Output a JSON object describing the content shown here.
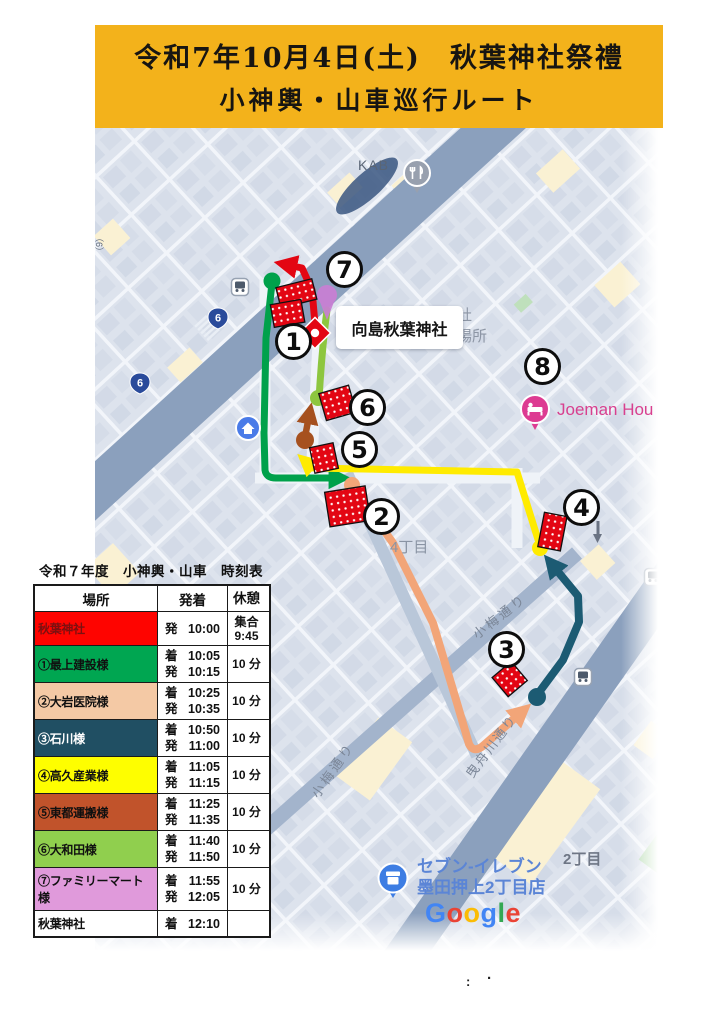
{
  "banner": {
    "line1": "令和7年10月4日(土)　秋葉神社祭禮",
    "line2": "小神輿・山車巡行ルート",
    "bg": "#F3B21B"
  },
  "colors": {
    "route_red": "#E30613",
    "route_green": "#00A14B",
    "route_lightgreen": "#8DC63F",
    "route_yellow": "#FFEB00",
    "route_brown": "#A6511F",
    "route_peach": "#F2A578",
    "route_teal": "#1C5B73",
    "pin_purple": "#C97FD4",
    "pin_hotel": "#DD3B92",
    "pin_house": "#4A7BE8",
    "pin_store": "#3D7DE3",
    "pin_restaurant": "#98A0AE",
    "shrine_pin_red": "#E30613",
    "road": "#8BA0BD",
    "map_label_gray": "#7C8798",
    "poi_label_blue": "#5B85D6",
    "joeman_label_pink": "#D8408F"
  },
  "map": {
    "labels": {
      "kab": "KAB",
      "shrine_box": "向島秋葉神社",
      "hidden1": "社",
      "hidden2": "場所",
      "joeman": "Joeman Hou",
      "chome4": "4丁目",
      "koume1": "小梅通り",
      "koume2": "小梅通り",
      "hikifune": "曳舟川通り",
      "chome2": "2丁目",
      "seveneleven_line1": "セブン-イレブン",
      "seveneleven_line2": "墨田押上2丁目店",
      "route6": "6",
      "edge_fragment": "（6）"
    },
    "google_letters": [
      "G",
      "o",
      "o",
      "g",
      "l",
      "e"
    ],
    "google_colors": [
      "#4285F4",
      "#EA4335",
      "#FBBC05",
      "#4285F4",
      "#34A853",
      "#EA4335"
    ],
    "stops": [
      {
        "n": "1"
      },
      {
        "n": "2"
      },
      {
        "n": "3"
      },
      {
        "n": "4"
      },
      {
        "n": "5"
      },
      {
        "n": "6"
      },
      {
        "n": "7"
      },
      {
        "n": "8"
      }
    ]
  },
  "timetable": {
    "title": "令和７年度　小神輿・山車　時刻表",
    "headers": [
      "場所",
      "発着",
      "休憩"
    ],
    "rows": [
      {
        "place": "秋葉神社",
        "bg": "#FE0400",
        "fg": "#7B1010",
        "t1k": "発",
        "t1v": "10:00",
        "t2k": "",
        "t2v": "",
        "r1": "集合",
        "r2": "9:45"
      },
      {
        "place": "①最上建設様",
        "bg": "#00A651",
        "fg": "#101010",
        "t1k": "着",
        "t1v": "10:05",
        "t2k": "発",
        "t2v": "10:15",
        "r1": "10 分",
        "r2": ""
      },
      {
        "place": "②大岩医院様",
        "bg": "#F4C9A5",
        "fg": "#101010",
        "t1k": "着",
        "t1v": "10:25",
        "t2k": "発",
        "t2v": "10:35",
        "r1": "10 分",
        "r2": ""
      },
      {
        "place": "③石川様",
        "bg": "#204F63",
        "fg": "#FFFFFF",
        "t1k": "着",
        "t1v": "10:50",
        "t2k": "発",
        "t2v": "11:00",
        "r1": "10 分",
        "r2": ""
      },
      {
        "place": "④高久産業様",
        "bg": "#FEFE00",
        "fg": "#101010",
        "t1k": "着",
        "t1v": "11:05",
        "t2k": "発",
        "t2v": "11:15",
        "r1": "10 分",
        "r2": ""
      },
      {
        "place": "⑤東都運搬様",
        "bg": "#C1532B",
        "fg": "#101010",
        "t1k": "着",
        "t1v": "11:25",
        "t2k": "発",
        "t2v": "11:35",
        "r1": "10 分",
        "r2": ""
      },
      {
        "place": "⑥大和田様",
        "bg": "#90CF4E",
        "fg": "#101010",
        "t1k": "着",
        "t1v": "11:40",
        "t2k": "発",
        "t2v": "11:50",
        "r1": "10 分",
        "r2": ""
      },
      {
        "place": "⑦ファミリーマート様",
        "bg": "#E09ADB",
        "fg": "#101010",
        "t1k": "着",
        "t1v": "11:55",
        "t2k": "発",
        "t2v": "12:05",
        "r1": "10 分",
        "r2": ""
      },
      {
        "place": "秋葉神社",
        "bg": "#FFFFFF",
        "fg": "#101010",
        "t1k": "着",
        "t1v": "12:10",
        "t2k": "",
        "t2v": "",
        "r1": "",
        "r2": ""
      }
    ]
  },
  "footer": {
    "colon": ":",
    "dot": "·"
  }
}
